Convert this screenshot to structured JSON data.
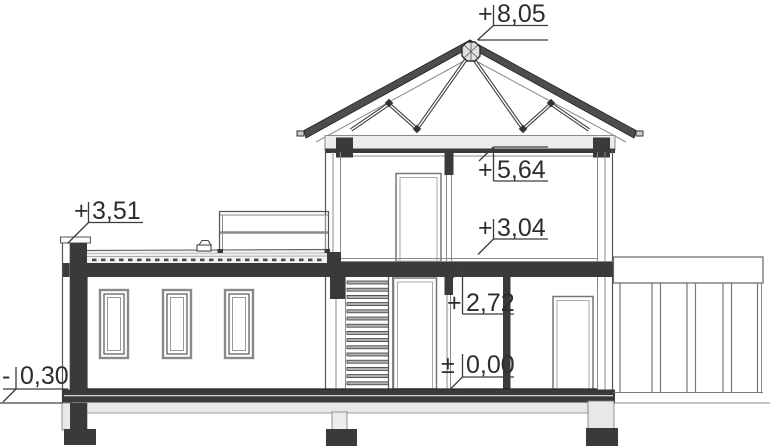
{
  "drawing": {
    "kind": "architectural-cross-section",
    "levels": [
      {
        "name": "ridge",
        "sign": "+",
        "value": "8,05"
      },
      {
        "name": "attic-ceiling",
        "sign": "+",
        "value": "5,64"
      },
      {
        "name": "flat-roof-parapet",
        "sign": "+",
        "value": "3,51"
      },
      {
        "name": "first-floor",
        "sign": "+",
        "value": "3,04"
      },
      {
        "name": "ground-ceiling",
        "sign": "+",
        "value": "2,72"
      },
      {
        "name": "ground-floor",
        "sign": "±",
        "value": "0,00"
      },
      {
        "name": "terrain",
        "sign": "-",
        "value": "0,30"
      }
    ],
    "colors": {
      "cut_element": "#3a3a3a",
      "slab_light": "#ececec",
      "roof_band": "#4d4d4d",
      "line": "#555555",
      "background": "#ffffff"
    }
  }
}
